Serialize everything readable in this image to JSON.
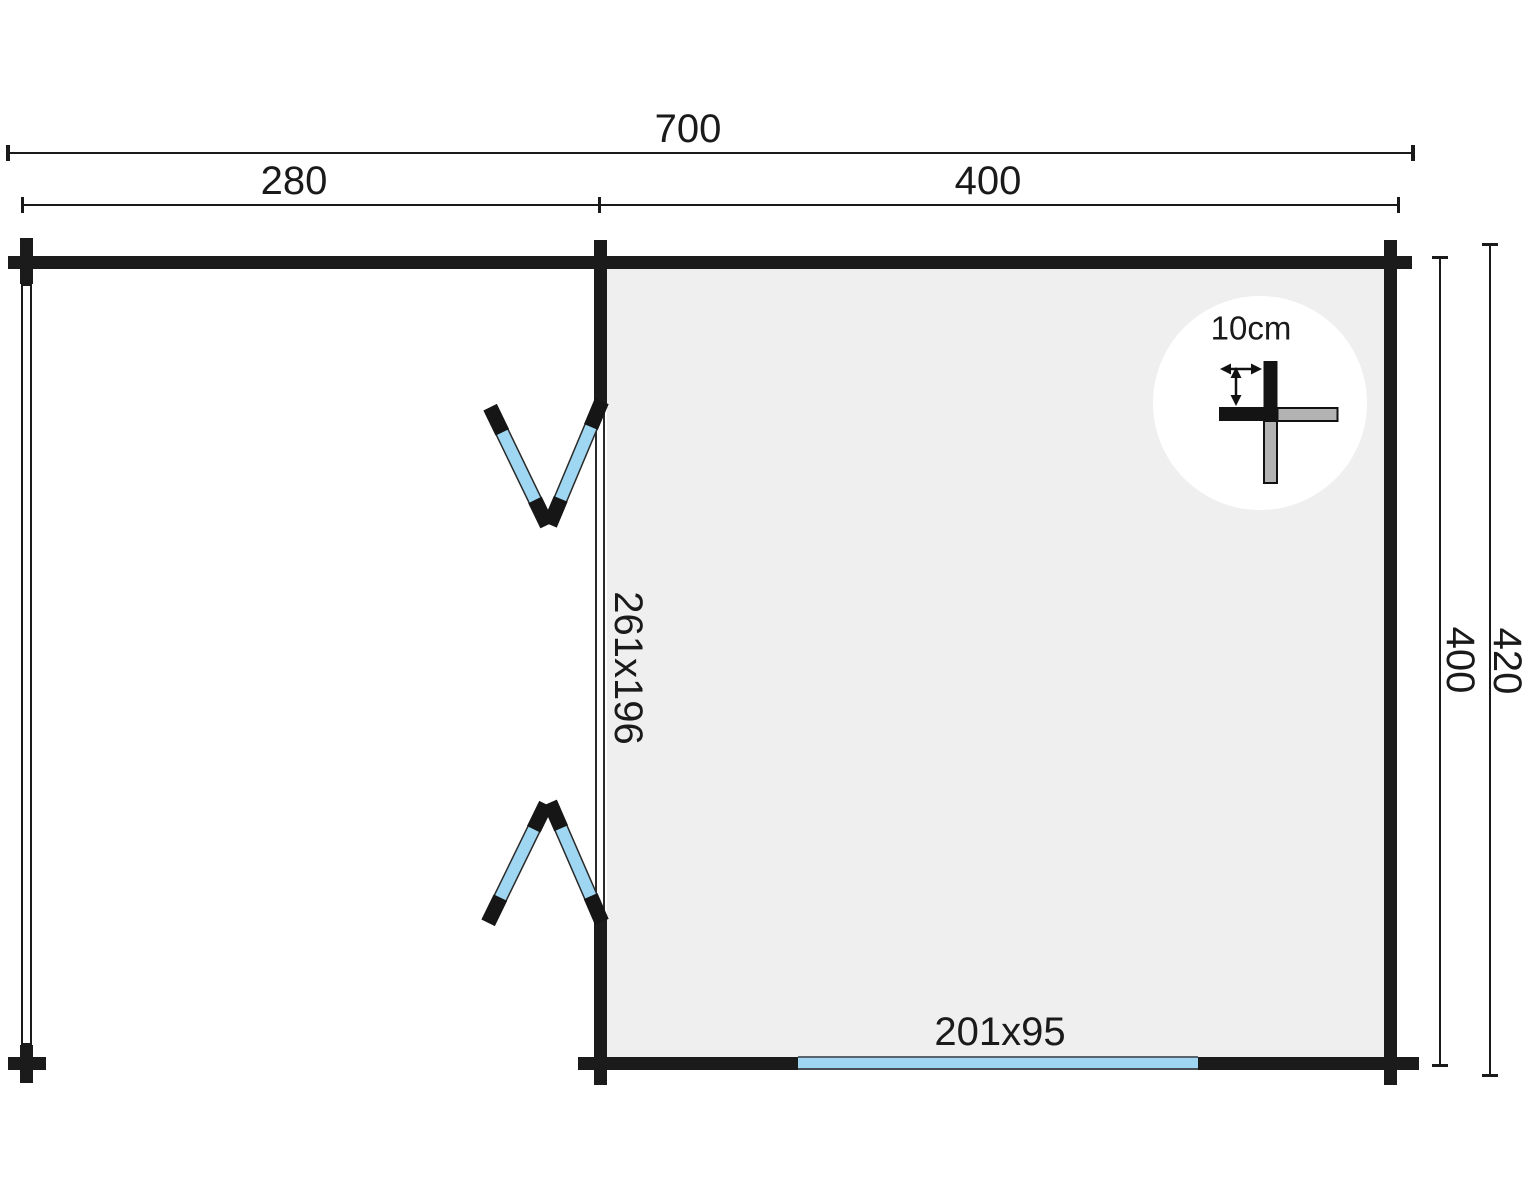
{
  "diagram": {
    "kind": "log-cabin-floor-plan",
    "dims": {
      "overall_width": "700",
      "porch_width": "280",
      "cabin_width_top": "400",
      "cabin_depth_inner": "400",
      "cabin_depth_outer": "420"
    },
    "openings": {
      "double_door_label": "261x196",
      "window_label": "201x95"
    },
    "wall_detail": {
      "log_thickness_label": "10cm"
    },
    "colors": {
      "wall_black": "#1b1b1b",
      "room_fill": "#efeff0",
      "glass_blue": "#9fd7f2",
      "beam_gray": "#b3b3b3",
      "detail_circle_fill": "#ffffff"
    }
  }
}
